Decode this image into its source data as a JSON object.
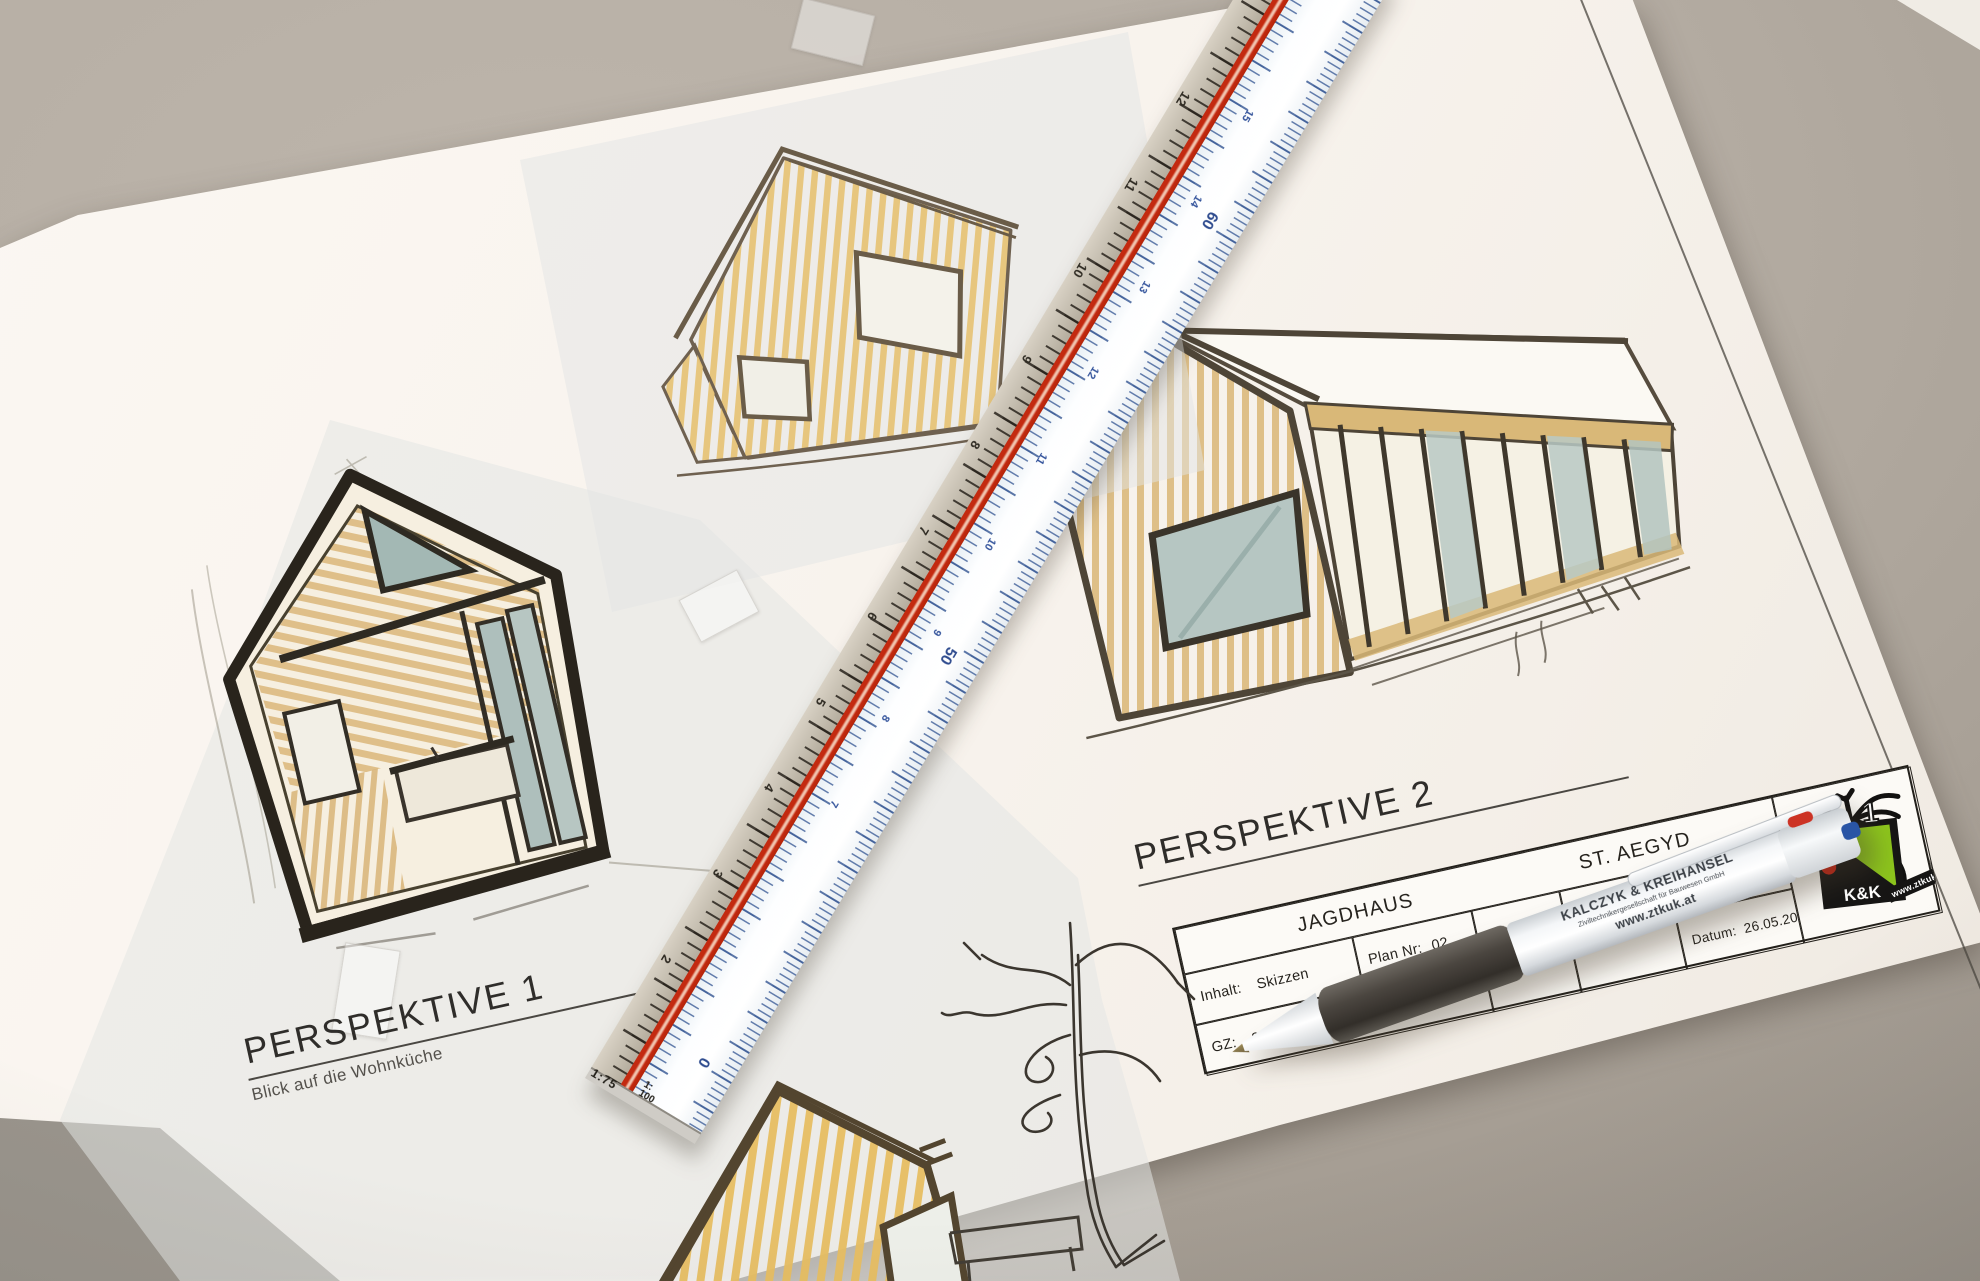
{
  "perspective1": {
    "title": "PERSPEKTIVE 1",
    "subtitle": "Blick auf die Wohnküche"
  },
  "perspective2": {
    "title": "PERSPEKTIVE 2"
  },
  "title_block": {
    "project_left": "JAGDHAUS",
    "project_right": "ST. AEGYD",
    "inhalt_label": "Inhalt:",
    "inhalt_value": "Skizzen",
    "plan_label": "Plan Nr:",
    "plan_value": "02",
    "gz_label": "GZ:",
    "gz_value": "2602 03",
    "gez_label": "Gez:",
    "gez_value": "LM",
    "scale_label": "M",
    "scale_value": "1:500",
    "studie": "Studie 1.0",
    "datum_label": "Datum:",
    "datum_value": "26.05.2020"
  },
  "logo": {
    "kk": "K&K",
    "url": "www.ztkuk.at",
    "one": "1"
  },
  "pen": {
    "brand": "KALCZYK & KREIHANSEL",
    "subtitle": "Ziviltechnikergesellschaft für Bauwesen GmbH",
    "url": "www.ztkuk.at"
  },
  "ruler": {
    "scale_left": "1:75",
    "scale_right_top": "1:",
    "scale_right_bottom": "100",
    "zero": "0",
    "gray_numbers": [
      "2",
      "3",
      "4",
      "5",
      "6",
      "7",
      "8",
      "9",
      "10",
      "11",
      "12"
    ],
    "blue_numbers": [
      "7",
      "8",
      "9",
      "10",
      "11",
      "12",
      "13",
      "14",
      "15"
    ],
    "large_numbers": [
      "50",
      "60"
    ]
  },
  "colors": {
    "accent_red": "#c32a10",
    "logo_green": "#8cc41c",
    "logo_red_dot": "#cc2414",
    "wood_tan": "#ddbb80",
    "glass_blue": "#a9bec0",
    "ink": "#2c2721",
    "desk_gray": "#a69e94"
  }
}
